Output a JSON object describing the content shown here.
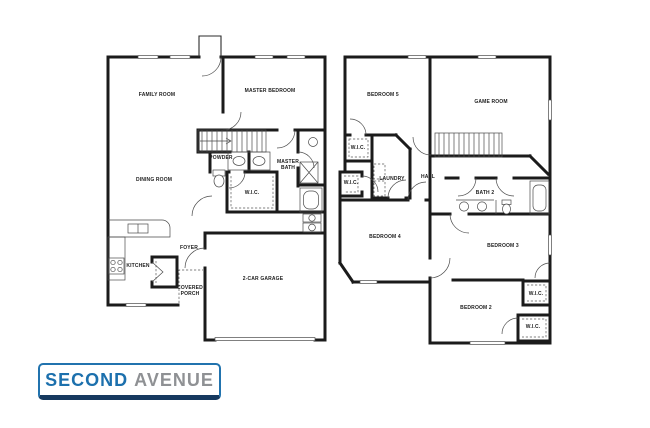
{
  "floor1": {
    "labels": {
      "family_room": "FAMILY ROOM",
      "master_bedroom": "MASTER BEDROOM",
      "dining_room": "DINING ROOM",
      "powder": "POWDER",
      "master_bath": "MASTER BATH",
      "wic": "W.I.C.",
      "kitchen": "KITCHEN",
      "foyer": "FOYER",
      "covered_porch": "COVERED PORCH",
      "garage": "2-CAR GARAGE"
    }
  },
  "floor2": {
    "labels": {
      "bedroom5": "BEDROOM 5",
      "game_room": "GAME ROOM",
      "wic_upper": "W.I.C.",
      "wic_lower": "W.I.C.",
      "laundry": "LAUNDRY",
      "hall": "HALL",
      "bath2": "BATH 2",
      "bedroom4": "BEDROOM 4",
      "bedroom3": "BEDROOM 3",
      "bedroom2": "BEDROOM 2",
      "wic_bed3": "W.I.C.",
      "wic_bed2": "W.I.C."
    }
  },
  "logo": {
    "word1": "SECOND",
    "word2": "AVENUE",
    "colors": {
      "blue": "#1c70ad",
      "gray": "#8f9194",
      "border": "#2173ae",
      "border_dark": "#16395f"
    }
  }
}
